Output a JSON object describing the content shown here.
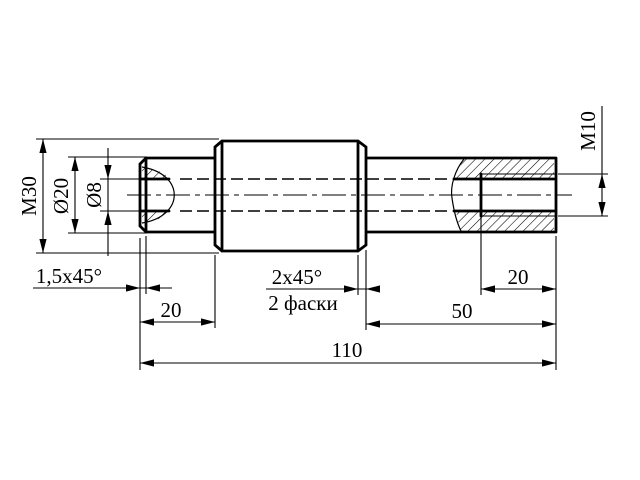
{
  "drawing": {
    "colors": {
      "line": "#000000",
      "background": "#ffffff"
    },
    "dimensions": {
      "thread_main": "M30",
      "dia_shaft": "Ø20",
      "dia_hole": "Ø8",
      "thread_hole": "M10",
      "chamfer_left": "1,5x45°",
      "chamfer_mid": "2x45°",
      "chamfer_mid_note": "2 фаски",
      "len_left_step": "20",
      "len_hole_depth": "20",
      "len_right_step": "50",
      "len_total": "110"
    }
  }
}
